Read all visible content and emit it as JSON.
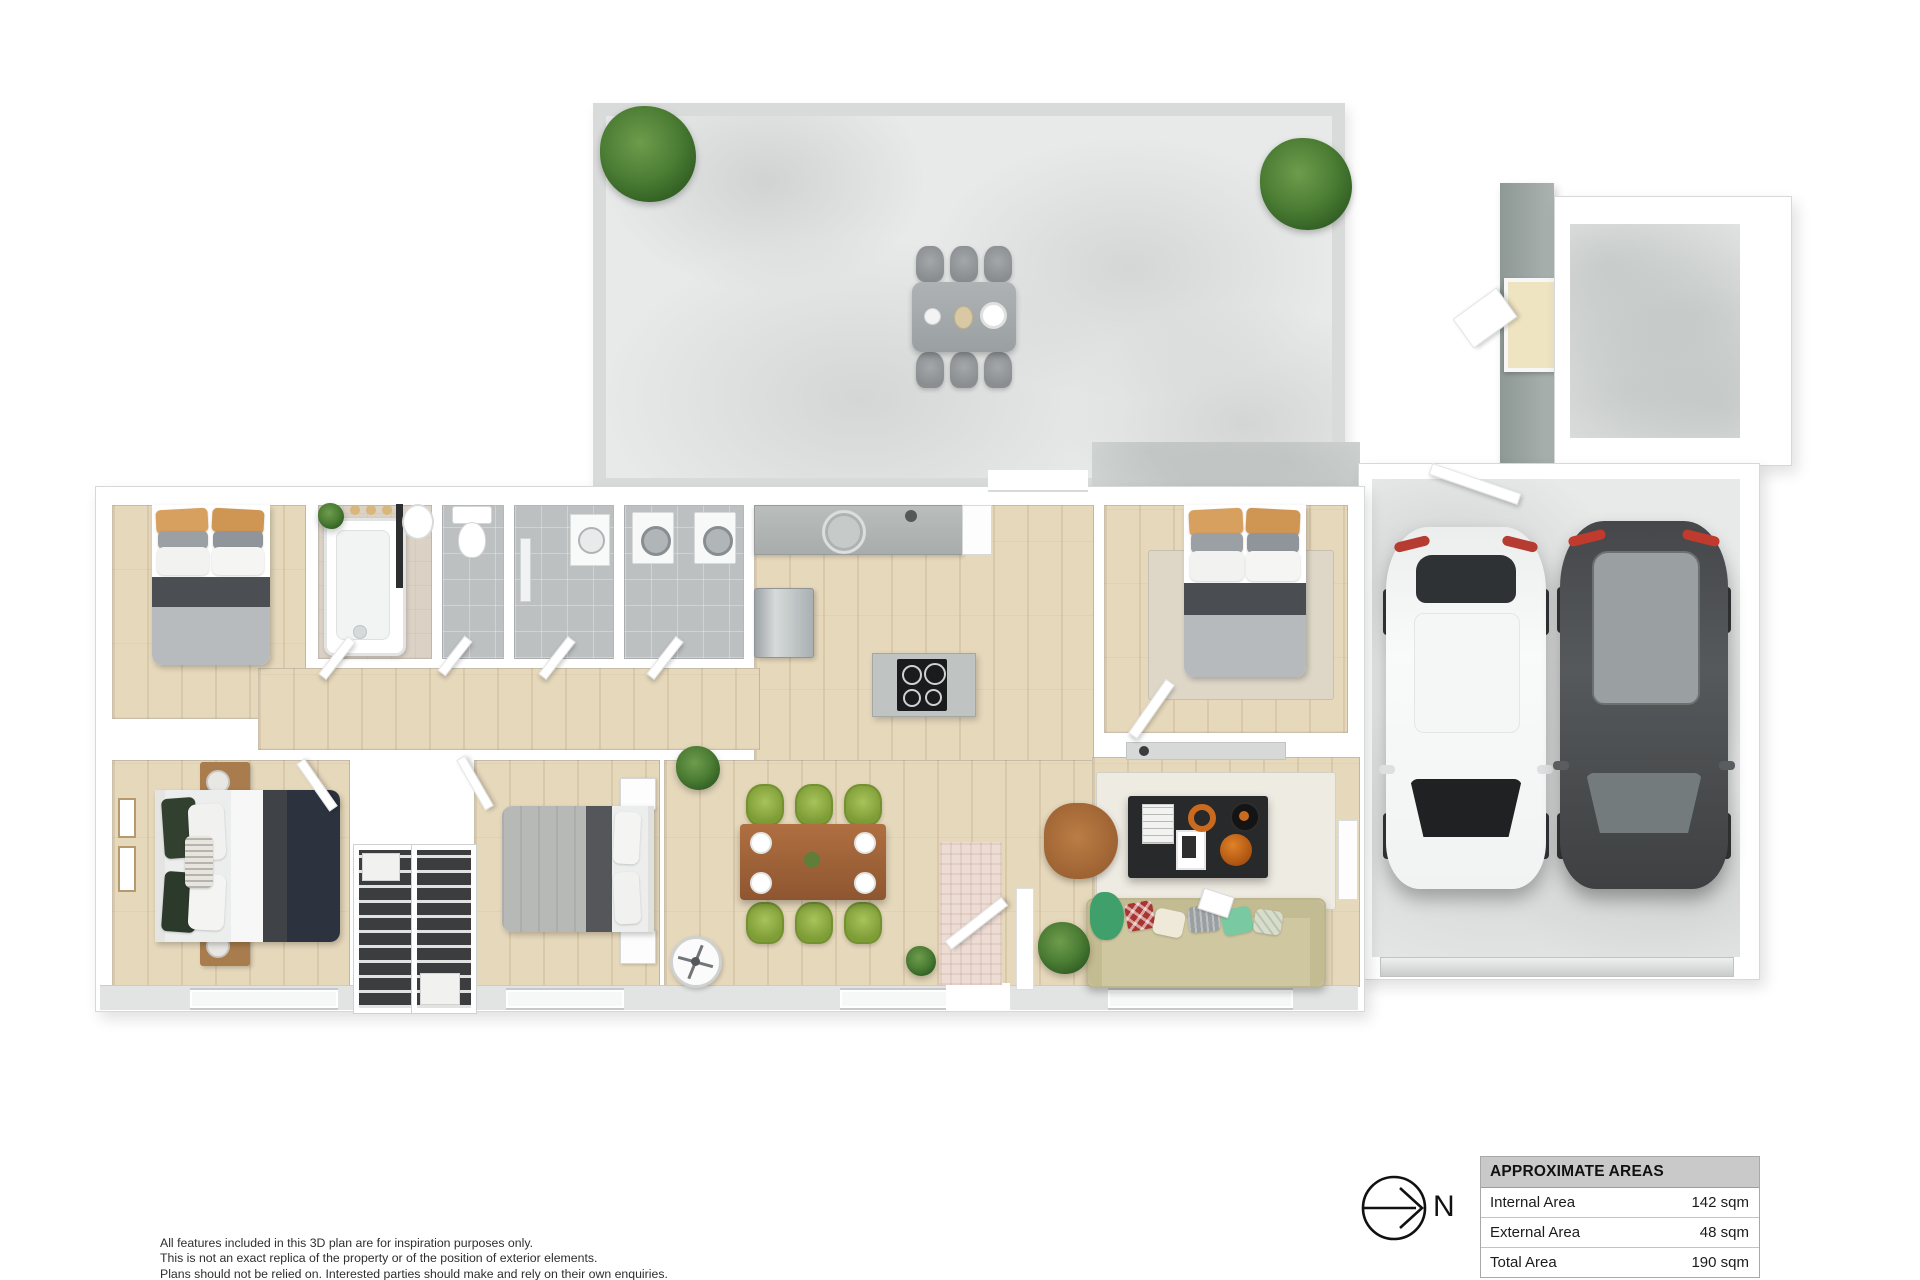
{
  "plan": {
    "compass_label": "N",
    "areas_table": {
      "header": "APPROXIMATE AREAS",
      "rows": [
        {
          "label": "Internal Area",
          "value": "142 sqm"
        },
        {
          "label": "External Area",
          "value": "48 sqm"
        },
        {
          "label": "Total Area",
          "value": "190 sqm"
        }
      ]
    },
    "disclaimer": {
      "line1": "All features included in this 3D plan are for inspiration purposes only.",
      "line2": "This is not an exact replica of the property or of the position of exterior elements.",
      "line3": "Plans should not be relied on. Interested parties should make and rely on their own enquiries."
    },
    "colors": {
      "concrete_floor": "#e8eae9",
      "wood_floor": "#e6d8bb",
      "tile_floor": "#bcc0c0",
      "wall": "#ffffff",
      "chair_green": "#8fae3f",
      "dining_table_wood": "#a96a3e",
      "sofa_beige": "#cfc7a0",
      "car_white": "#f6f7f7",
      "car_dark": "#4b4d4f",
      "taillight_red": "#b63b30"
    }
  }
}
